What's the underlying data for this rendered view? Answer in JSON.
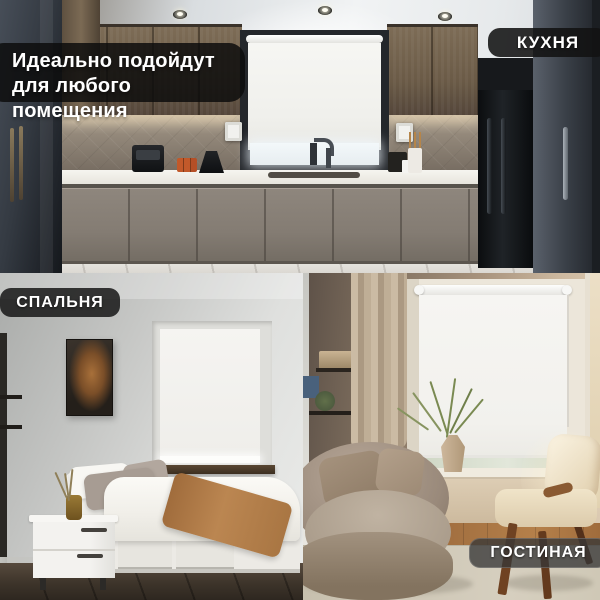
{
  "headline": {
    "line1": "Идеально подойдут",
    "line2": "для любого помещения"
  },
  "panels": [
    {
      "id": "kitchen",
      "label": "КУХНЯ"
    },
    {
      "id": "bedroom",
      "label": "СПАЛЬНЯ"
    },
    {
      "id": "living_room",
      "label": "ГОСТИНАЯ"
    }
  ],
  "colors": {
    "label_background": "#141414",
    "label_text": "#ffffff",
    "headline_background": "#0d0d0d",
    "blind_fabric": "#f3f2ef"
  }
}
